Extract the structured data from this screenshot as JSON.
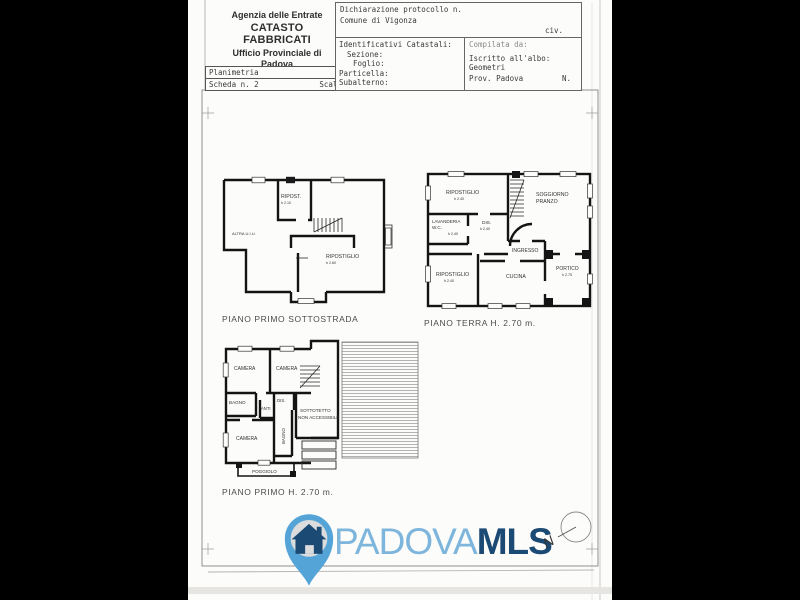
{
  "header": {
    "agency": {
      "line1": "Agenzia delle Entrate",
      "line2": "CATASTO FABBRICATI",
      "line3": "Ufficio Provinciale di",
      "line4": "Padova"
    },
    "planimetria": {
      "title": "Planimetria",
      "scheda": "Scheda n. 2",
      "scala": "Scala 1:200"
    },
    "declaration": {
      "protocol": "Dichiarazione protocollo n.",
      "comune": "Comune di Vigonza",
      "civ": "civ."
    },
    "catastali": {
      "title": "Identificativi Catastali:",
      "fields": [
        "Sezione:",
        "Foglio:",
        "Particella:",
        "Subalterno:"
      ]
    },
    "compiler": {
      "compilata": "Compilata da:",
      "albo": "Iscritto all'albo:",
      "albo_value": "Geometri",
      "prov": "Prov. Padova",
      "n": "N."
    }
  },
  "plans": [
    {
      "caption": "PIANO PRIMO SOTTOSTRADA",
      "rooms": [
        {
          "line1": "RIPOST.",
          "h": "h 2.10"
        },
        {
          "line1": "ALTRA U.I.U."
        },
        {
          "line1": "RIPOSTIGLIO",
          "h": "h 2.60"
        }
      ]
    },
    {
      "caption": "PIANO TERRA H. 2.70 m.",
      "rooms": [
        {
          "line1": "RIPOSTIGLIO",
          "h": "h 2.40"
        },
        {
          "line1": "SOGGIORNO",
          "line2": "PRANZO"
        },
        {
          "line1": "LAVANDERIA",
          "line2": "W.C.",
          "h": "h 2.40"
        },
        {
          "line1": "DIS.",
          "h": "h 2.40"
        },
        {
          "line1": "INGRESSO"
        },
        {
          "line1": "RIPOSTIGLIO",
          "h": "h 2.40"
        },
        {
          "line1": "CUCINA"
        },
        {
          "line1": "PORTICO",
          "h": "h 2.75"
        }
      ]
    },
    {
      "caption": "PIANO PRIMO H. 2.70 m.",
      "rooms": [
        {
          "line1": "CAMERA"
        },
        {
          "line1": "CAMERA"
        },
        {
          "line1": "BAGNO"
        },
        {
          "line1": "DIS."
        },
        {
          "line1": "ANTI"
        },
        {
          "line1": "CAMERA"
        },
        {
          "line1": "BAGNO"
        },
        {
          "line1": "SOTTOTETTO",
          "line2": "NON ACCESSIBILE"
        },
        {
          "line1": "POGGIOLO"
        }
      ]
    }
  ],
  "footer": {
    "brand_first": "PADOVA",
    "brand_second": "MLS",
    "compass_letter": "N"
  },
  "colors": {
    "brand_light": "#7db5dc",
    "brand_dark": "#1b4a74",
    "pin_blue": "#54a4d8"
  }
}
